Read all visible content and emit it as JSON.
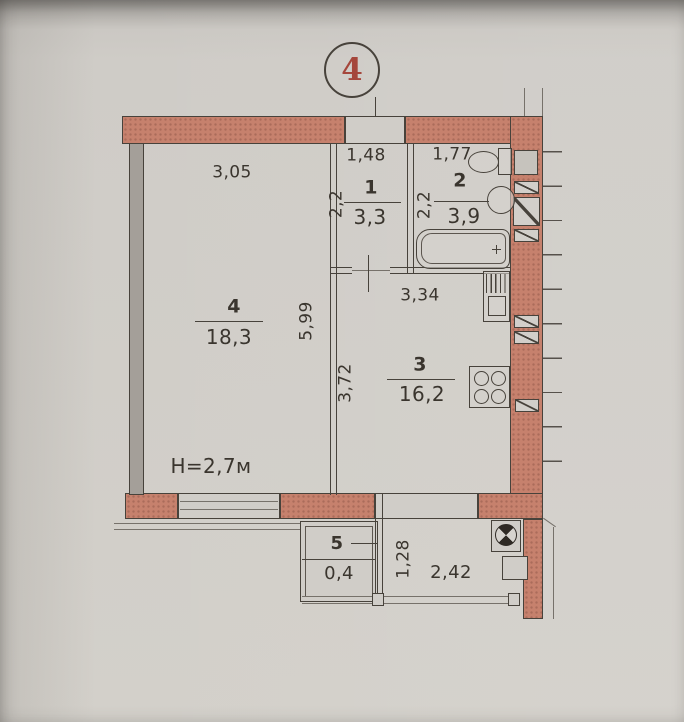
{
  "section": {
    "number": "4"
  },
  "rooms": {
    "room1": {
      "number": "1",
      "area": "3,3",
      "width_dim": "1,48",
      "depth_dim": "2,2"
    },
    "room2": {
      "number": "2",
      "area": "3,9",
      "width_dim": "1,77",
      "depth_dim": "2,2"
    },
    "room3": {
      "number": "3",
      "area": "16,2",
      "width_dim": "3,34",
      "depth_dim": "3,72"
    },
    "room4": {
      "number": "4",
      "area": "18,3",
      "width_dim": "3,05",
      "depth_dim": "5,99",
      "ceiling_height": "H=2,7м"
    },
    "room5": {
      "number": "5",
      "area": "0,4"
    }
  },
  "balcony": {
    "width_dim": "2,42",
    "depth_dim": "1,28"
  },
  "colors": {
    "wall_fill": "#c6816d",
    "line": "#47423b",
    "section_number": "#a5463b",
    "paper": "#cfccc7"
  }
}
